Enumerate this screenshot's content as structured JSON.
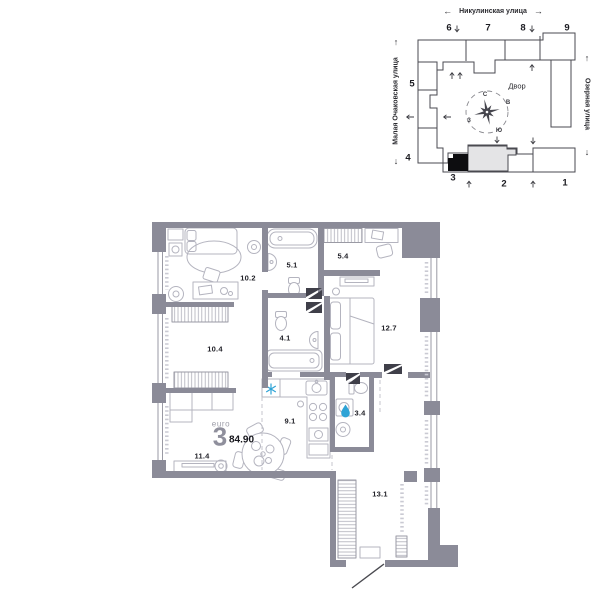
{
  "site_plan": {
    "street_top": "Никулинская улица",
    "street_left": "Малая Очаковская улица",
    "street_right": "Озерная улица",
    "courtyard": "Двор",
    "buildings": {
      "b1": "1",
      "b2": "2",
      "b3": "3",
      "b4": "4",
      "b5": "5",
      "b6": "6",
      "b7": "7",
      "b8": "8",
      "b9": "9"
    },
    "compass": {
      "north": "С",
      "east": "В",
      "west": "З",
      "south": "Ю"
    }
  },
  "icons": {
    "arrow_left": "←",
    "arrow_right": "→",
    "arrow_up": "↑",
    "arrow_down": "↓"
  },
  "unit": {
    "format_label": "euro",
    "rooms_count": "3",
    "total_area": "84.90"
  },
  "rooms": {
    "bedroom_1": "10.2",
    "bathroom_1": "5.1",
    "wardrobe": "5.4",
    "bedroom_2": "12.7",
    "hall": "4.1",
    "bedroom_3": "10.4",
    "kitchen": "9.1",
    "bathroom_2": "3.4",
    "living": "11.4",
    "corridor": "13.1"
  },
  "colors": {
    "wall": "#8b8b98",
    "accent_blue": "#2ea3d6",
    "highlight_black": "#0d0d10",
    "selected_section": "#e4e4e6"
  }
}
